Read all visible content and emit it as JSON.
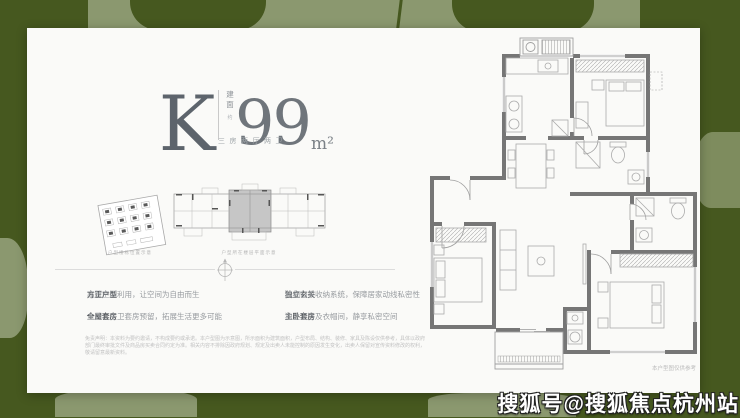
{
  "colors": {
    "background_green": "#46581f",
    "leaf_sage": "#8b986f",
    "card_white": "#fafaf8",
    "title_gray": "#5d646c",
    "wall_gray": "#767676"
  },
  "unit": {
    "letter": "K",
    "area_label_char1": "建",
    "area_label_char2": "面",
    "area_approx": "约",
    "area_value": "99",
    "area_unit": "m²",
    "layout_text": "三房两厅两卫"
  },
  "diagrams": {
    "site_caption": "户型楼栋位置示意",
    "floorplate_caption": "户型所在楼层平面示意"
  },
  "features": {
    "separator": "｜",
    "items": [
      {
        "label": "方正户型",
        "desc": "高效空间利用，让空间为自由而生"
      },
      {
        "label": "全屋套房",
        "desc": "主卧、主卫套房预留，拓展生活更多可能"
      },
      {
        "label": "独立玄关",
        "desc": "精细归家收纳系统，保障居家动线私密性"
      },
      {
        "label": "主卧套房",
        "desc": "独立卫浴及衣帽间，静享私密空间"
      }
    ]
  },
  "disclaimer": "免责声明：本资料为要约邀请，不构成要约或承诺。本户型图为示意图，所示面积为建筑面积，户型布局、结构、装修、家具及陈设仅供参考，具体以政府部门最终审批文件及商品房买卖合同约定为准。相关内容不排除因政府规划、规定及出卖人未能控制的原因发生变化，出卖人保留对宣传资料修改的权利，敬请留意最新资料。",
  "plan_note": "本户型图仅供参考",
  "watermark": "搜狐号@搜狐焦点杭州站"
}
